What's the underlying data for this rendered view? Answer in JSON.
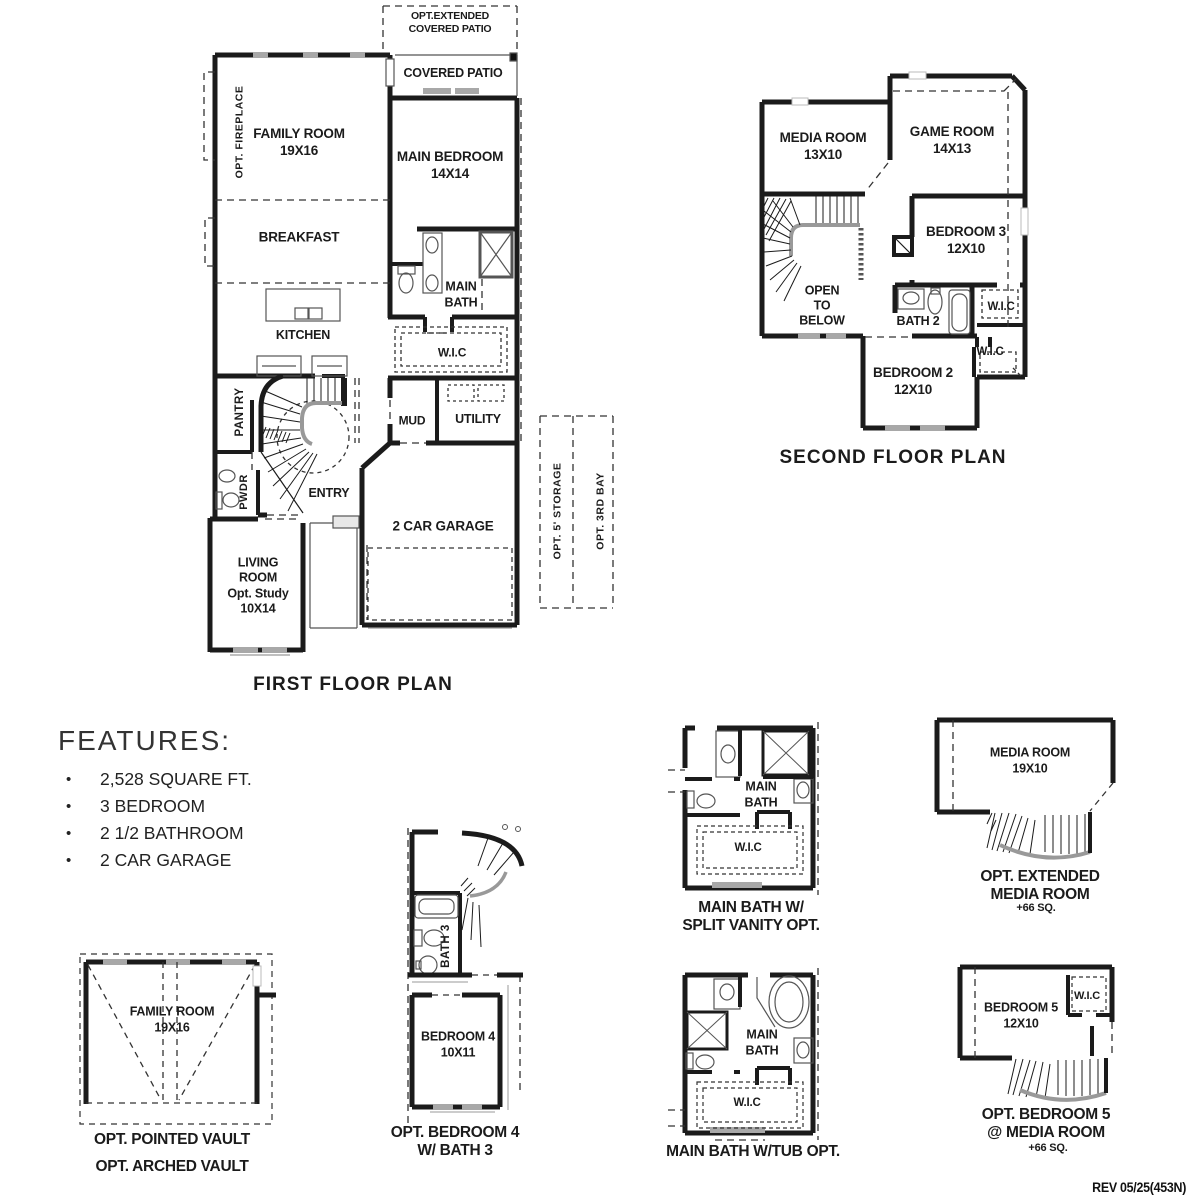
{
  "first_floor": {
    "title": "FIRST FLOOR PLAN",
    "labels": {
      "opt_extended_covered_patio": "OPT.EXTENDED\nCOVERED PATIO",
      "covered_patio": "COVERED PATIO",
      "family_room": "FAMILY ROOM\n19X16",
      "opt_fireplace": "OPT. FIREPLACE",
      "main_bedroom": "MAIN BEDROOM\n14X14",
      "breakfast": "BREAKFAST",
      "main_bath": "MAIN\nBATH",
      "kitchen": "KITCHEN",
      "wic": "W.I.C",
      "pantry": "PANTRY",
      "mud": "MUD",
      "utility": "UTILITY",
      "pwdr": "PWDR",
      "entry": "ENTRY",
      "garage": "2 CAR GARAGE",
      "living_room": "LIVING\nROOM\nOpt. Study\n10X14",
      "opt_5_storage": "OPT. 5' STORAGE",
      "opt_3rd_bay": "OPT. 3RD BAY"
    }
  },
  "second_floor": {
    "title": "SECOND FLOOR PLAN",
    "labels": {
      "media_room": "MEDIA ROOM\n13X10",
      "game_room": "GAME ROOM\n14X13",
      "bedroom_3": "BEDROOM 3\n12X10",
      "open_to_below": "OPEN\nTO\nBELOW",
      "bath_2": "BATH 2",
      "wic_a": "W.I.C",
      "wic_b": "W.I.C",
      "bedroom_2": "BEDROOM 2\n12X10"
    }
  },
  "features": {
    "heading": "FEATURES:",
    "bullet": "•",
    "items": [
      "2,528 SQUARE FT.",
      "3 BEDROOM",
      "2 1/2 BATHROOM",
      "2 CAR GARAGE"
    ]
  },
  "options": {
    "vault": {
      "room": "FAMILY ROOM\n19X16",
      "caption1": "OPT. POINTED VAULT",
      "caption2": "OPT. ARCHED VAULT"
    },
    "bedroom4": {
      "bath": "BATH 3",
      "room": "BEDROOM 4\n10X11",
      "caption": "OPT. BEDROOM 4\nW/ BATH 3"
    },
    "bath_split": {
      "room": "MAIN\nBATH",
      "wic": "W.I.C",
      "caption": "MAIN BATH W/\nSPLIT VANITY OPT."
    },
    "bath_tub": {
      "room": "MAIN\nBATH",
      "wic": "W.I.C",
      "caption": "MAIN BATH W/TUB OPT."
    },
    "ext_media": {
      "room": "MEDIA ROOM\n19X10",
      "caption": "OPT. EXTENDED\nMEDIA ROOM",
      "sub": "+66 SQ."
    },
    "bedroom5": {
      "room": "BEDROOM 5\n12X10",
      "wic": "W.I.C",
      "caption": "OPT. BEDROOM 5\n@ MEDIA ROOM",
      "sub": "+66 SQ."
    }
  },
  "footer": {
    "rev": "REV 05/25(453N)"
  }
}
